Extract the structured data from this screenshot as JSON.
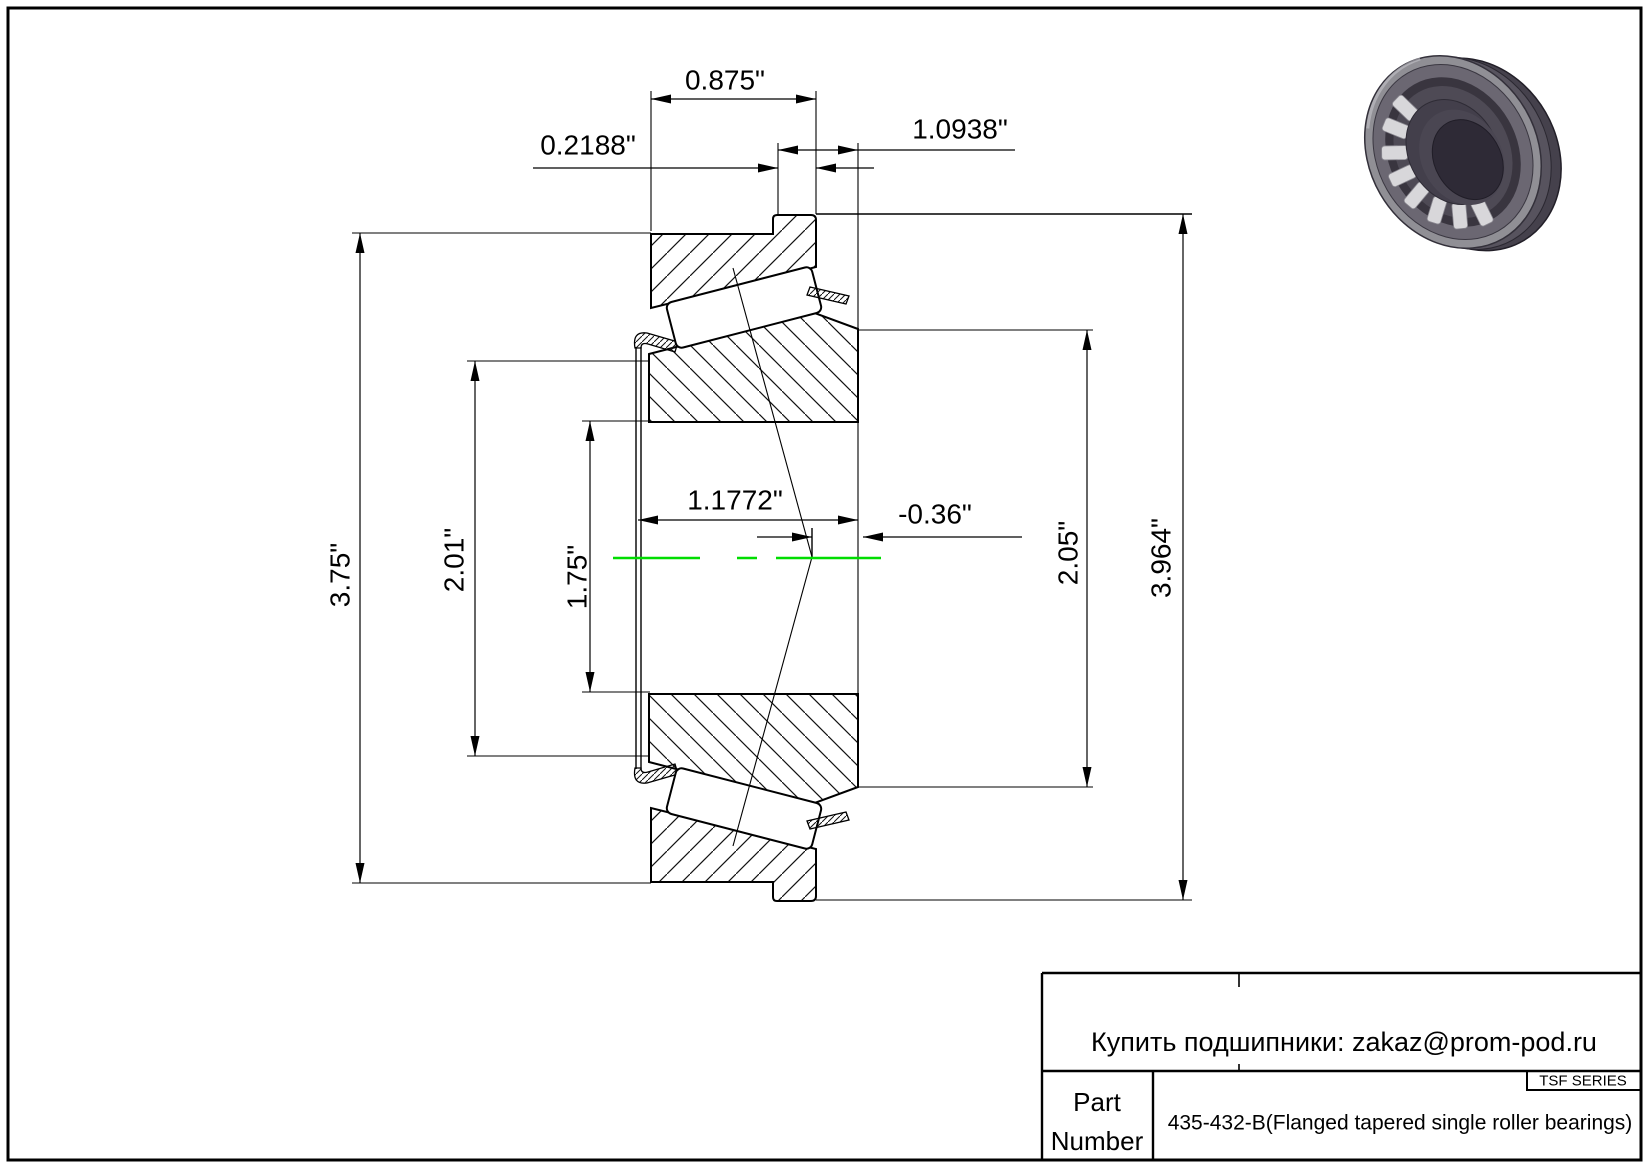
{
  "page": {
    "background": "#ffffff",
    "line_color": "#000000",
    "centerline_color": "#00dd00",
    "render_colors": {
      "ring_back": "#45414c",
      "ring_side": "#57535e",
      "ring_face": "#908f95",
      "ring_step": "#6b6772",
      "cavity": "#39353f",
      "roller_band": "#4e4a55",
      "roller": "#d8d7da",
      "cage": "#433f4b",
      "bore_wall": "#4a4652",
      "bore_hole": "#2e2a36"
    }
  },
  "dimensions": {
    "cup_width": "0.875\"",
    "flange_width": "0.2188\"",
    "overall_width": "1.0938\"",
    "cone_width": "1.1772\"",
    "effective_center": "-0.36\"",
    "cup_od": "3.75\"",
    "cage_od": "2.01\"",
    "bore": "1.75\"",
    "rib_od": "2.05\"",
    "flange_od": "3.964\""
  },
  "title_block": {
    "contact_line": "Купить подшипники: zakaz@prom-pod.ru",
    "series_label": "TSF SERIES",
    "part_label_top": "Part",
    "part_label_bottom": "Number",
    "part_description": "435-432-B(Flanged tapered single roller bearings)"
  }
}
